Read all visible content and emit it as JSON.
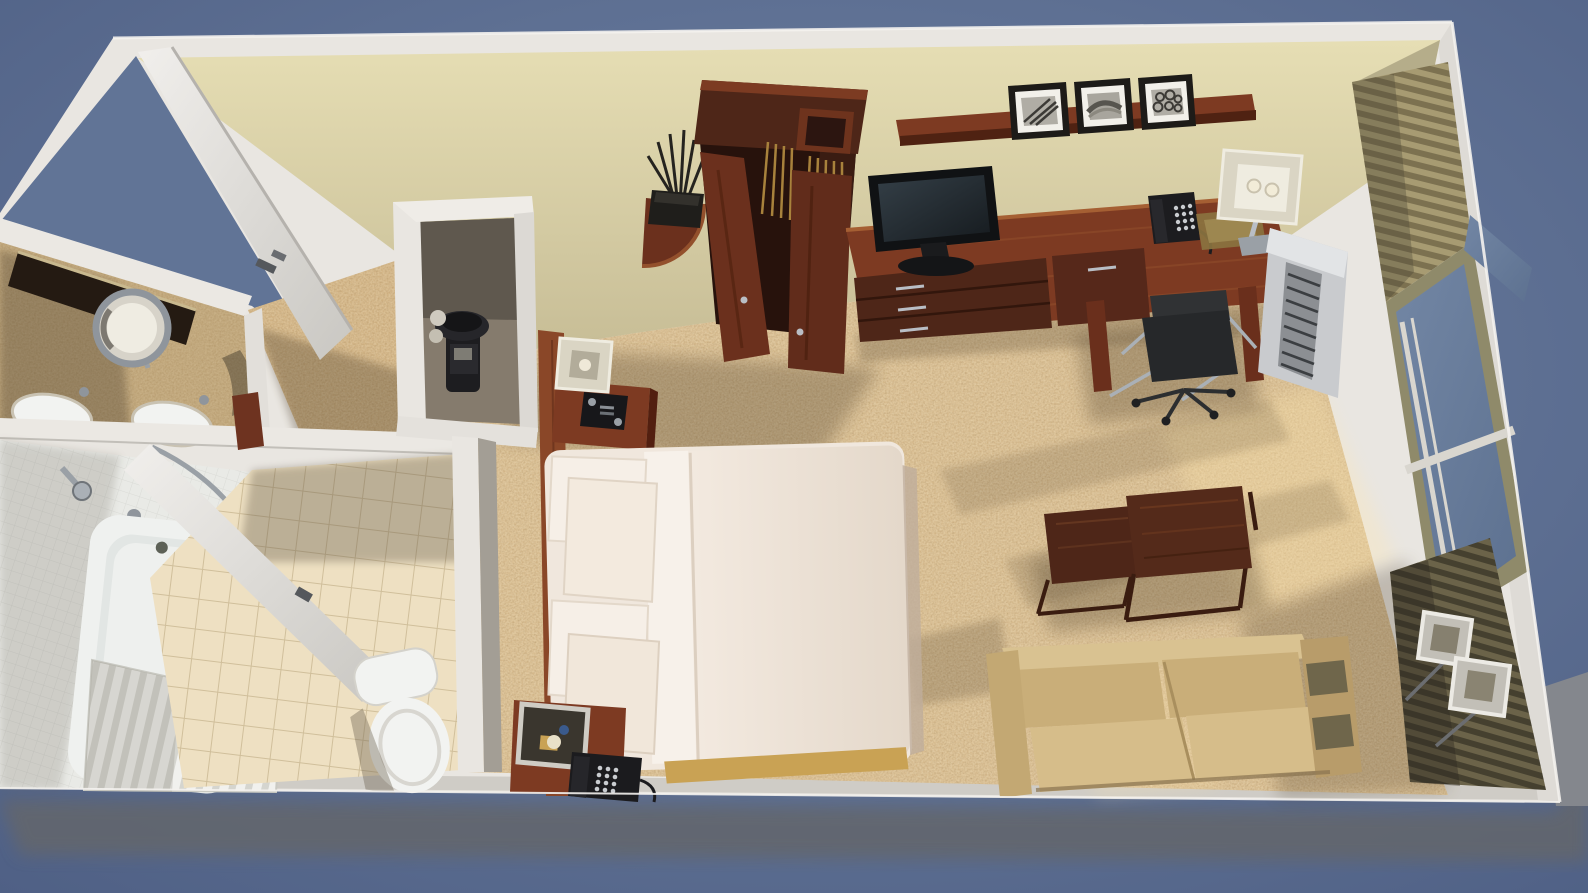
{
  "meta": {
    "type": "3d-architectural-render",
    "subject": "Top-down cutaway 3D rendering of a hotel guest room floor plan",
    "view": "overhead perspective, room rotated slightly clockwise",
    "image_width": 1588,
    "image_height": 893,
    "visible_text": "none"
  },
  "palette": {
    "background": "#57688b",
    "background_light": "#6e82a1",
    "ground_shadow": "#64666c",
    "wall_white": "#e9e6e1",
    "wall_band_shade": "#cfccc6",
    "wall_face_cream_light": "#e6deb4",
    "wall_face_cream_dark": "#c7bd96",
    "carpet": "#d4b381",
    "carpet_light": "#ffe7ae",
    "carpet_shadow": "#4a3a28",
    "corridor_carpet": "#cda975",
    "wood_dark": "#4e2618",
    "wood": "#6b301d",
    "wood_light": "#8a4728",
    "wood_top": "#7d3a22",
    "bed_linen": "#f0e7dd",
    "pillow": "#f6efe7",
    "bed_skirt_gold": "#c9a254",
    "sofa": "#c9ae79",
    "sofa_light": "#d6bd8a",
    "sofa_dark": "#b89c6a",
    "tile_floor": "#eee0c2",
    "shower_tile": "#e9eae6",
    "tub_white": "#eff1ef",
    "toilet_white": "#f2f3f1",
    "granite_counter": "#b89b6c",
    "mirror_dark": "#241a12",
    "chrome": "#b9bec5",
    "black_device": "#1b1b1e",
    "tv_bezel": "#101214",
    "lamp_shade": "#dad5c4",
    "lamp_shade_inner": "#efece0",
    "curtain_tan": "#a79b72",
    "curtain_olive": "#6b6349",
    "window_glass": "#6d82a1",
    "window_frame_olive": "#8f8a6a",
    "mullion_white": "#d9d6cf",
    "ac_body": "#c9cbce",
    "ac_vent": "#3b3e41",
    "plant_dark": "#25231f",
    "chair_black": "#26282a",
    "hanger_brass": "#a8823c",
    "print_frame": "#1d1b18",
    "print_mat": "#f2f0ea"
  },
  "scene": {
    "rooms": [
      {
        "id": "bedroom",
        "label": "Guest bedroom with king bed, media console, work desk and seating area"
      },
      {
        "id": "bathroom",
        "label": "Bathroom with vanity, tub shower and toilet"
      },
      {
        "id": "entry",
        "label": "Entry corridor with open door and closet niche"
      }
    ],
    "objects": [
      {
        "id": "entry-door",
        "label": "Entry door, swung fully open",
        "state": "open"
      },
      {
        "id": "closet-niche",
        "label": "Closet niche with black appliance (coffee maker / safe)"
      },
      {
        "id": "vanity-counter",
        "label": "Granite vanity counter with two white sinks"
      },
      {
        "id": "vanity-mirror",
        "label": "Wall mirror seen edge-on"
      },
      {
        "id": "magnifying-mirror",
        "label": "Round chrome magnifying mirror"
      },
      {
        "id": "bathtub",
        "label": "White bathtub with chrome shower head"
      },
      {
        "id": "shower-curtain",
        "label": "White pleated shower curtain on curved rod"
      },
      {
        "id": "bathroom-door",
        "label": "Bathroom door, open",
        "state": "open"
      },
      {
        "id": "toilet",
        "label": "White toilet on beige tile floor"
      },
      {
        "id": "bed",
        "label": "Bed with white duvet, four pillows and gold bed skirt"
      },
      {
        "id": "headboard",
        "label": "Dark wood headboard wall panel"
      },
      {
        "id": "nightstand-top",
        "label": "Nightstand with alarm clock radio and square-shade lamp"
      },
      {
        "id": "nightstand-bottom",
        "label": "Nightstand with telephone and square-shade lamp"
      },
      {
        "id": "wardrobe",
        "label": "Dark wood wardrobe with both doors open, brass hangers inside",
        "state": "open"
      },
      {
        "id": "corner-table",
        "label": "Quarter-round corner table with twig plant"
      },
      {
        "id": "media-console",
        "label": "Long wood media console with three drawers"
      },
      {
        "id": "tv",
        "label": "Black flat-screen TV on console"
      },
      {
        "id": "wall-shelf",
        "label": "Floating wood shelf"
      },
      {
        "id": "framed-prints",
        "label": "Three black-framed black-and-white prints",
        "count": 3
      },
      {
        "id": "desk",
        "label": "Wood work desk with phone, tray and lamp"
      },
      {
        "id": "desk-chair",
        "label": "Black desk chair with chrome frame"
      },
      {
        "id": "ptac-unit",
        "label": "White PTAC air-conditioning unit under window"
      },
      {
        "id": "window-wall",
        "label": "Window wall with blue glass, white mullions and olive frame"
      },
      {
        "id": "curtains",
        "label": "Tan upper and dark olive lower drapery panels"
      },
      {
        "id": "floor-lamps",
        "label": "Two square-shade floor lamps by the window",
        "count": 2
      },
      {
        "id": "sofa",
        "label": "Tan two-seat sofa against bottom wall"
      },
      {
        "id": "nesting-tables",
        "label": "Two dark wood nesting cube coffee tables",
        "count": 2
      },
      {
        "id": "carpet",
        "label": "Tan woven carpet with window light and shadows"
      }
    ],
    "counts": {
      "pillows": 4,
      "framed_prints": 3,
      "sinks": 2,
      "nightstands": 2,
      "table_lamps": 2,
      "floor_lamps": 2,
      "telephones": 3,
      "nesting_tables": 2,
      "wardrobe_doors_open": 2
    }
  }
}
